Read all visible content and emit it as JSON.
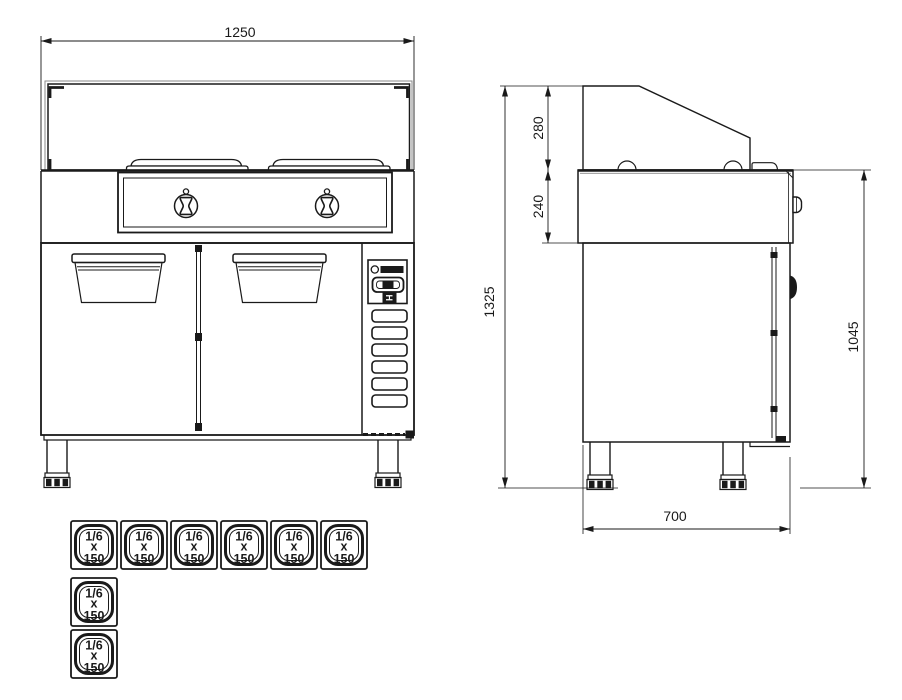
{
  "dimensions": {
    "width": "1250",
    "guard_height": "280",
    "worktop_height": "240",
    "total_height": "1325",
    "body_height": "1045",
    "depth": "700"
  },
  "gn_pan": {
    "size": "1/6",
    "multiplier": "x",
    "depth": "150"
  },
  "control_panel": {
    "switch_label": "H"
  },
  "colors": {
    "line": "#1a1a1a",
    "background": "#ffffff"
  }
}
